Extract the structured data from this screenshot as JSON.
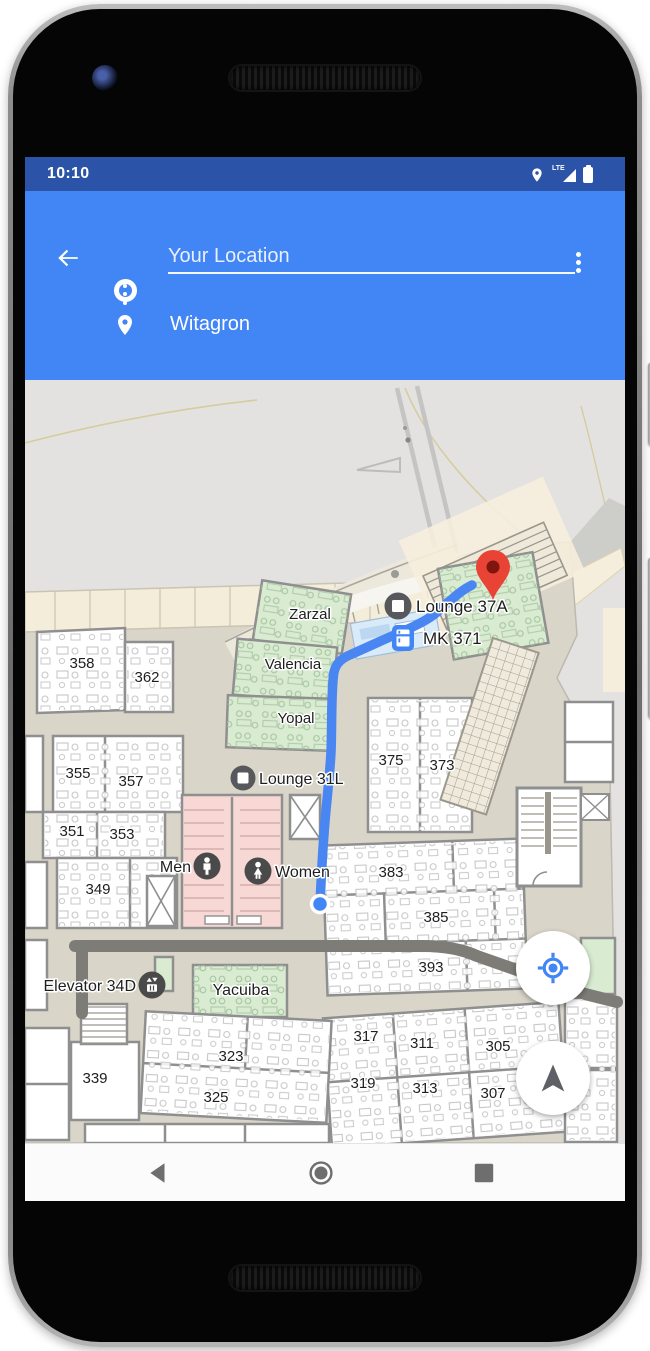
{
  "status_bar": {
    "time": "10:10",
    "network_label": "LTE"
  },
  "header": {
    "origin_field": {
      "value": "Your Location"
    },
    "destination_field": {
      "value": "Witagron"
    }
  },
  "map": {
    "labels": {
      "zarzal": "Zarzal",
      "valencia": "Valencia",
      "yopal": "Yopal",
      "yacuiba": "Yacuiba",
      "lounge_37a": "Lounge 37A",
      "mk_371": "MK 371",
      "lounge_31l": "Lounge 31L",
      "men": "Men",
      "women": "Women",
      "elevator_34d": "Elevator 34D",
      "r358": "358",
      "r362": "362",
      "r355": "355",
      "r357": "357",
      "r351": "351",
      "r353": "353",
      "r349": "349",
      "r339": "339",
      "r375": "375",
      "r373": "373",
      "r383": "383",
      "r385": "385",
      "r393": "393",
      "r323": "323",
      "r325": "325",
      "r317": "317",
      "r311": "311",
      "r305": "305",
      "r319": "319",
      "r313": "313",
      "r307": "307"
    },
    "colors": {
      "route_blue": "#4a86f2",
      "accent_blue": "#4285f4",
      "marker_red": "#e94335",
      "room_green": "#d9ecd2",
      "restroom_pink": "#f8d8d5",
      "floor": "#d9d5c9",
      "outdoor": "#e3e2e1",
      "path_beige": "#f6eedd",
      "corridor_dark": "#7d7c77"
    }
  }
}
